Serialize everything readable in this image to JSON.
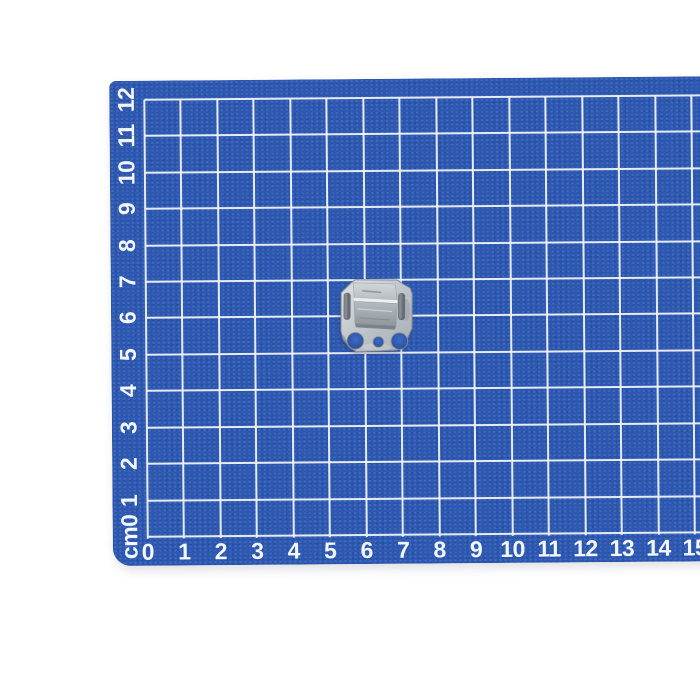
{
  "mat": {
    "x_axis_labels": [
      "0",
      "1",
      "2",
      "3",
      "4",
      "5",
      "6",
      "7",
      "8",
      "9",
      "10",
      "11",
      "12",
      "13",
      "14",
      "15"
    ],
    "y_axis_labels": [
      "cm0",
      "1",
      "2",
      "3",
      "4",
      "5",
      "6",
      "7",
      "8",
      "9",
      "10",
      "11",
      "12"
    ],
    "colors": {
      "mat_blue": "#2c58b2",
      "grid_line_white": "#f0f3f7",
      "label_white": "#f3f6fa",
      "page_background": "#ffffff"
    }
  },
  "object": {
    "name": "galvanized-metal-mounting-clip",
    "colors": {
      "metal_light": "#d9dde0",
      "metal_mid": "#b3b9be",
      "metal_dark": "#7b828a",
      "hole_blue": "#3b6ac6"
    }
  }
}
